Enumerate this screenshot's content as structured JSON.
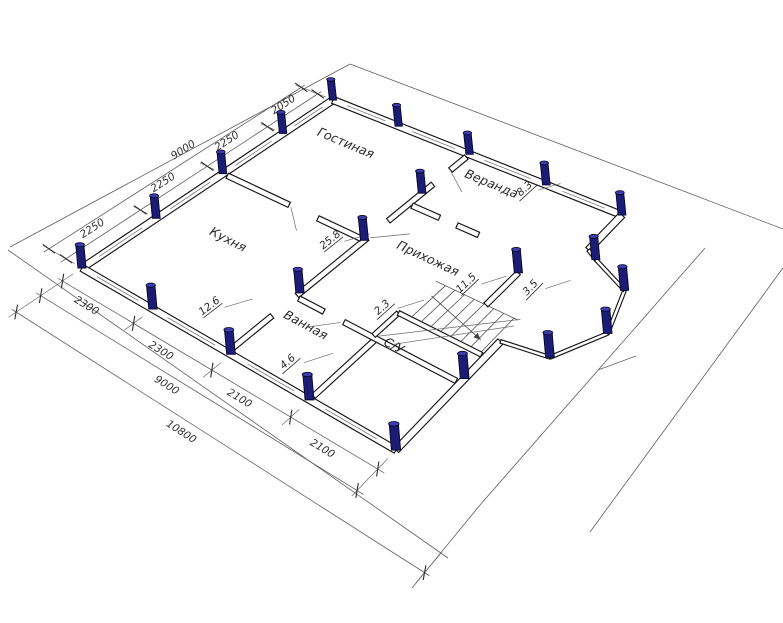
{
  "rooms": [
    {
      "name": "Кухня",
      "area": "12.6"
    },
    {
      "name": "Гостиная",
      "area": "25.8"
    },
    {
      "name": "Веранда",
      "area": "8.3"
    },
    {
      "name": "Прихожая",
      "area": "11.5"
    },
    {
      "name": "Ванная",
      "area": "4.6"
    },
    {
      "name": "С/У",
      "area": "2.3"
    },
    {
      "name": "",
      "area": "3.5"
    }
  ],
  "dimensions": {
    "top_chain": [
      "2250",
      "2250",
      "2250",
      "2050"
    ],
    "top_total": "9000",
    "left_chain": [
      "2300",
      "2300",
      "2100",
      "2100"
    ],
    "left_total": "9000",
    "left_overall": "10800"
  },
  "colors": {
    "pile_body": "#1c1c74",
    "pile_top": "#3d3dab",
    "pile_edge": "#06062e",
    "line": "#5f5f5f",
    "wall": "#161616"
  }
}
